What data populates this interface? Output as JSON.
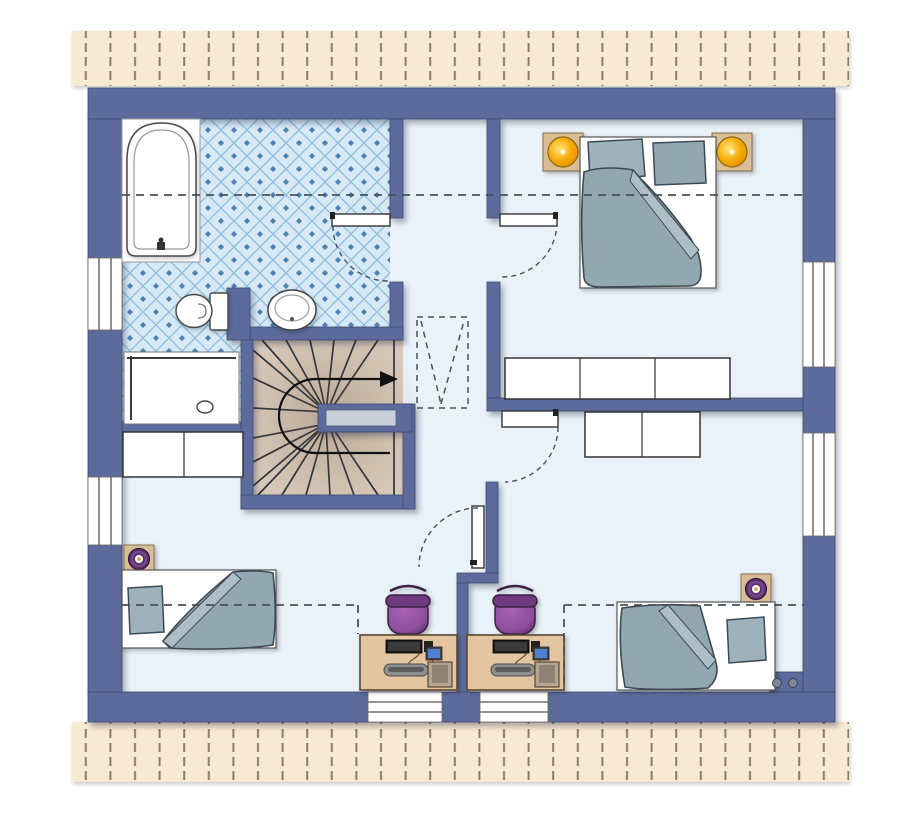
{
  "meta": {
    "title": "architectural-floor-plan-upper-floor",
    "visible_text": "none",
    "description": "Top-view floor plan of an attic storey with bathroom, landing with winder staircase, one double bedroom and two single bedrooms with desks"
  },
  "palette": {
    "wall": "#5c6b9c",
    "wall_outline": "#3d4a6e",
    "floor": "#e9f2f8",
    "tile_bg": "#d6e9f5",
    "tile_line": "#8fbedd",
    "tile_dot": "#4b80b2",
    "roof_bg": "#f8e9d2",
    "roof_dash": "#8b7c69",
    "stair": "#d8cabb",
    "stair_line": "#2e333b",
    "fabric": "#93a7b0",
    "fabric_light": "#aebec6",
    "fabric_outline": "#3c4a55",
    "pillow": "#9fb2bb",
    "mat": "#ffffff",
    "wood": "#d8bd96",
    "wood_outline": "#8a6f4d",
    "desk": "#e4c5a1",
    "desk_outline": "#5c4732",
    "purple": "#8d4f9c",
    "purple_dark": "#5f2f6e",
    "lamp_yellow": "#f6a800",
    "lamp_yellow_light": "#ffe680",
    "outline": "#4a4a4a",
    "dash": "#49505c",
    "window_line": "#555555",
    "slot": "#c9cfd9",
    "metal": "#8e8e8e",
    "screen_blue": "#4f7fd2",
    "tower": "#b4a592",
    "dot_fill": "#7e8798"
  },
  "rooms": [
    {
      "id": "bathroom",
      "position": "top-left",
      "floor_finish": "blue-diamond-tiles",
      "furniture": [
        "bathtub",
        "toilet",
        "washbasin",
        "shower-tray-with-drain"
      ]
    },
    {
      "id": "landing",
      "position": "center",
      "features": [
        "winder-staircase",
        "stair-direction-arrow",
        "dashed-roof-window-marker"
      ]
    },
    {
      "id": "bedroom-large",
      "position": "top-right",
      "furniture": [
        "double-bed",
        "pillow",
        "pillow",
        "duvet",
        "nightstand-with-yellow-lamp",
        "nightstand-with-yellow-lamp",
        "wardrobe-three-sections"
      ]
    },
    {
      "id": "bedroom-left",
      "position": "bottom-left",
      "furniture": [
        "single-bed",
        "pillow",
        "duvet",
        "nightstand-with-purple-lamp",
        "chest-two-sections",
        "desk-with-computer",
        "office-chair"
      ]
    },
    {
      "id": "bedroom-right",
      "position": "bottom-right",
      "furniture": [
        "single-bed",
        "pillow",
        "duvet",
        "nightstand-with-purple-lamp",
        "wardrobe-two-sections",
        "desk-with-computer",
        "office-chair"
      ]
    }
  ],
  "openings": {
    "doors_with_swing_arc": [
      "bathroom-door",
      "bedroom-large-door",
      "bedroom-right-door",
      "bedroom-left-door"
    ],
    "windows": [
      "left-wall-upper",
      "left-wall-lower",
      "right-wall-upper",
      "right-wall-lower",
      "bottom-wall-left",
      "bottom-wall-right"
    ]
  },
  "annotations": {
    "dashed_horizontal_lines": "knee-wall / roof height lines across upper and lower rooms",
    "dashed_v_rectangle": "roof window above landing",
    "hatched_strips": "roof overhang hatching at top and bottom edges",
    "wall_dots": "two ventilation/chimney dots in bottom-right wall"
  }
}
